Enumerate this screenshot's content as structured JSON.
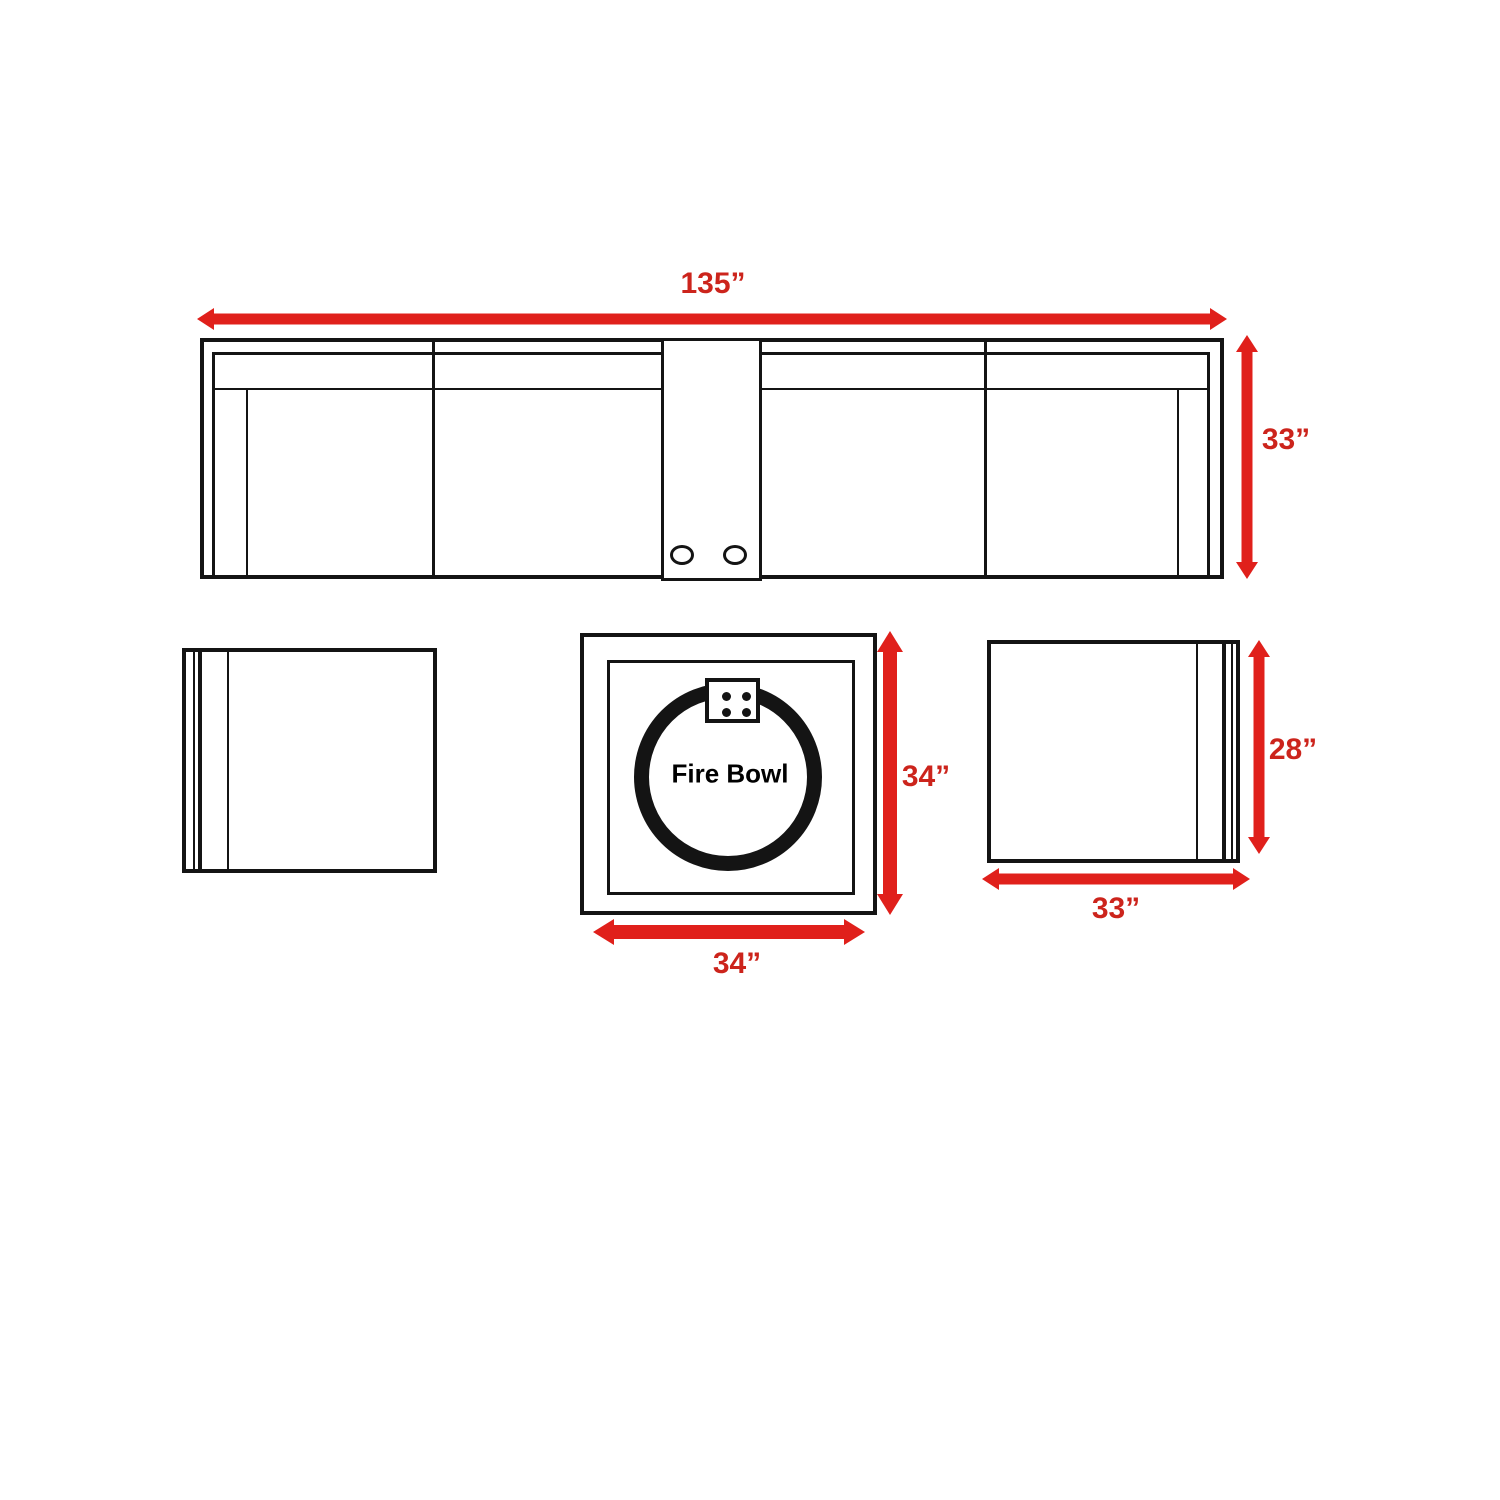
{
  "theme": {
    "background": "#ffffff",
    "line_color": "#141414",
    "arrow_red": "#e0201b",
    "label_red": "#cc241c"
  },
  "sofa": {
    "width_label": "135”",
    "depth_label": "33”"
  },
  "fire_table": {
    "label": "Fire Bowl",
    "height_label": "34”",
    "width_label": "34”"
  },
  "right_chair": {
    "width_label": "33”",
    "depth_label": "28”"
  }
}
